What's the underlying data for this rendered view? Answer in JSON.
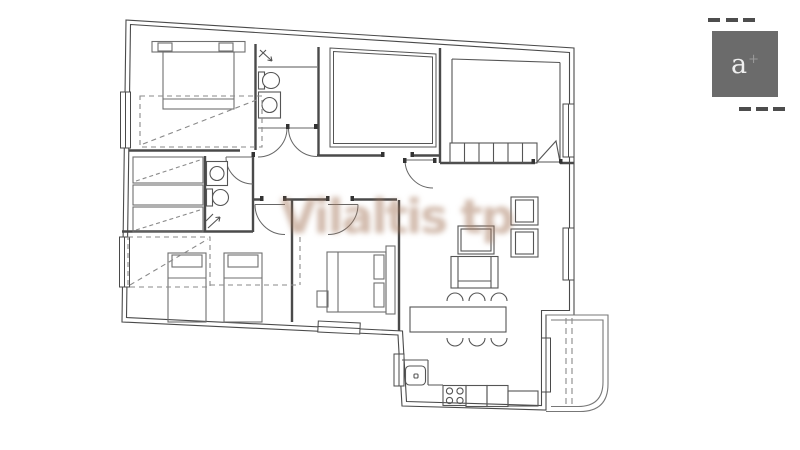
{
  "canvas": {
    "background": "#ffffff"
  },
  "watermark": {
    "text": "Vilaltis tp",
    "color": "rgba(165,120,92,0.50)"
  },
  "brand": {
    "logo_letter": "a",
    "logo_superscript": "+",
    "square_color": "#6b6b6b",
    "dash_color": "#4d4d4d"
  },
  "floor_plan": {
    "type": "apartment-floor-plan",
    "wall_color": "#4a4a4a",
    "furniture_color": "#6f6f6f",
    "dashed_color": "#8a8a8a",
    "elements": [
      "exterior-walls",
      "interior-walls",
      "windows",
      "door-arcs",
      "bedroom-double-bed",
      "bedroom-two-single-beds",
      "bedroom-bed-top-left",
      "bathroom-toilet",
      "bathroom-sink",
      "shower-corner",
      "wardrobe-dashed-outlines",
      "closet-row",
      "sofa",
      "armchairs",
      "side-table",
      "dining-table",
      "six-chairs",
      "kitchen-counter",
      "stove-four-burners",
      "kitchen-sink",
      "balcony-rounded"
    ]
  }
}
